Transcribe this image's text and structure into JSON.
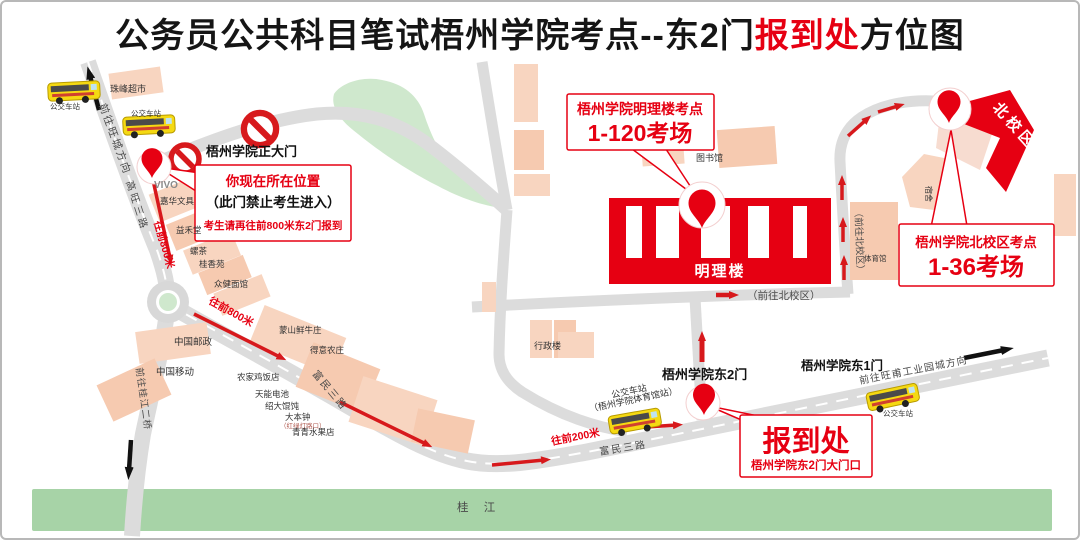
{
  "title": {
    "part1": "公务员公共科目笔试梧州学院考点--东2门",
    "highlight": "报到处",
    "part2": "方位图"
  },
  "colors": {
    "accent_red": "#e60012",
    "route_red": "#d7191c",
    "road_gray": "#dcdcdc",
    "building_pink": "#f8d5c0",
    "campus_green": "#cfe8cd",
    "river_green": "#a7d3a7",
    "bus_yellow": "#f5d912"
  },
  "callouts": {
    "current_location": {
      "line1": "你现在所在位置",
      "line2": "（此门禁止考生进入）",
      "line3": "考生请再往前800米东2门报到"
    },
    "minglilou": {
      "line1": "梧州学院明理楼考点",
      "line2": "1-120考场"
    },
    "north_campus": {
      "line1": "梧州学院北校区考点",
      "line2": "1-36考场"
    },
    "registration": {
      "line1": "报到处",
      "line2": "梧州学院东2门大门口"
    }
  },
  "gates": {
    "main_gate": "梧州学院正大门",
    "east_gate_2": "梧州学院东2门",
    "east_gate_1": "梧州学院东1门"
  },
  "campus": {
    "minglilou": "明理楼",
    "north_flag": "北校区",
    "library": "图书馆",
    "admin": "行政楼",
    "dorm": "宿舍",
    "gym": "体育馆"
  },
  "roads": {
    "wangcheng_dir": "前往旺城方向",
    "gaowang_rd": "高旺三路",
    "guijiang_bridge_dir": "前往桂江二桥",
    "fumin_rd": "富民三路",
    "wangfu_dir": "前往旺甫工业园城方向",
    "to_north_campus": "（前往北校区）",
    "ahead_800m": "往前800米",
    "ahead_200m": "往前200米"
  },
  "river": "桂 江",
  "bus_stop": "公交车站",
  "bus_stop_gym": "（梧州学院体育馆站）",
  "pois": {
    "supermarket": "珠峰超市",
    "vivo": "VIVO",
    "stationery": "嘉华文具",
    "yihetang": "益禾堂",
    "luocha": "螺茶",
    "guixiangyuan": "桂香苑",
    "noodle_house": "众健面馆",
    "china_post": "中国邮政",
    "china_mobile": "中国移动",
    "mengshan_beef": "蒙山鲜牛庄",
    "deyi_farm": "得意农庄",
    "farm_chicken": "农家鸡饭店",
    "tianneng_battery": "天能电池",
    "wonton": "绍大馄饨",
    "dabenzhong": "大本钟",
    "traffic_light_note": "（红绿灯路口）",
    "fruit_shop": "青青水果店"
  }
}
